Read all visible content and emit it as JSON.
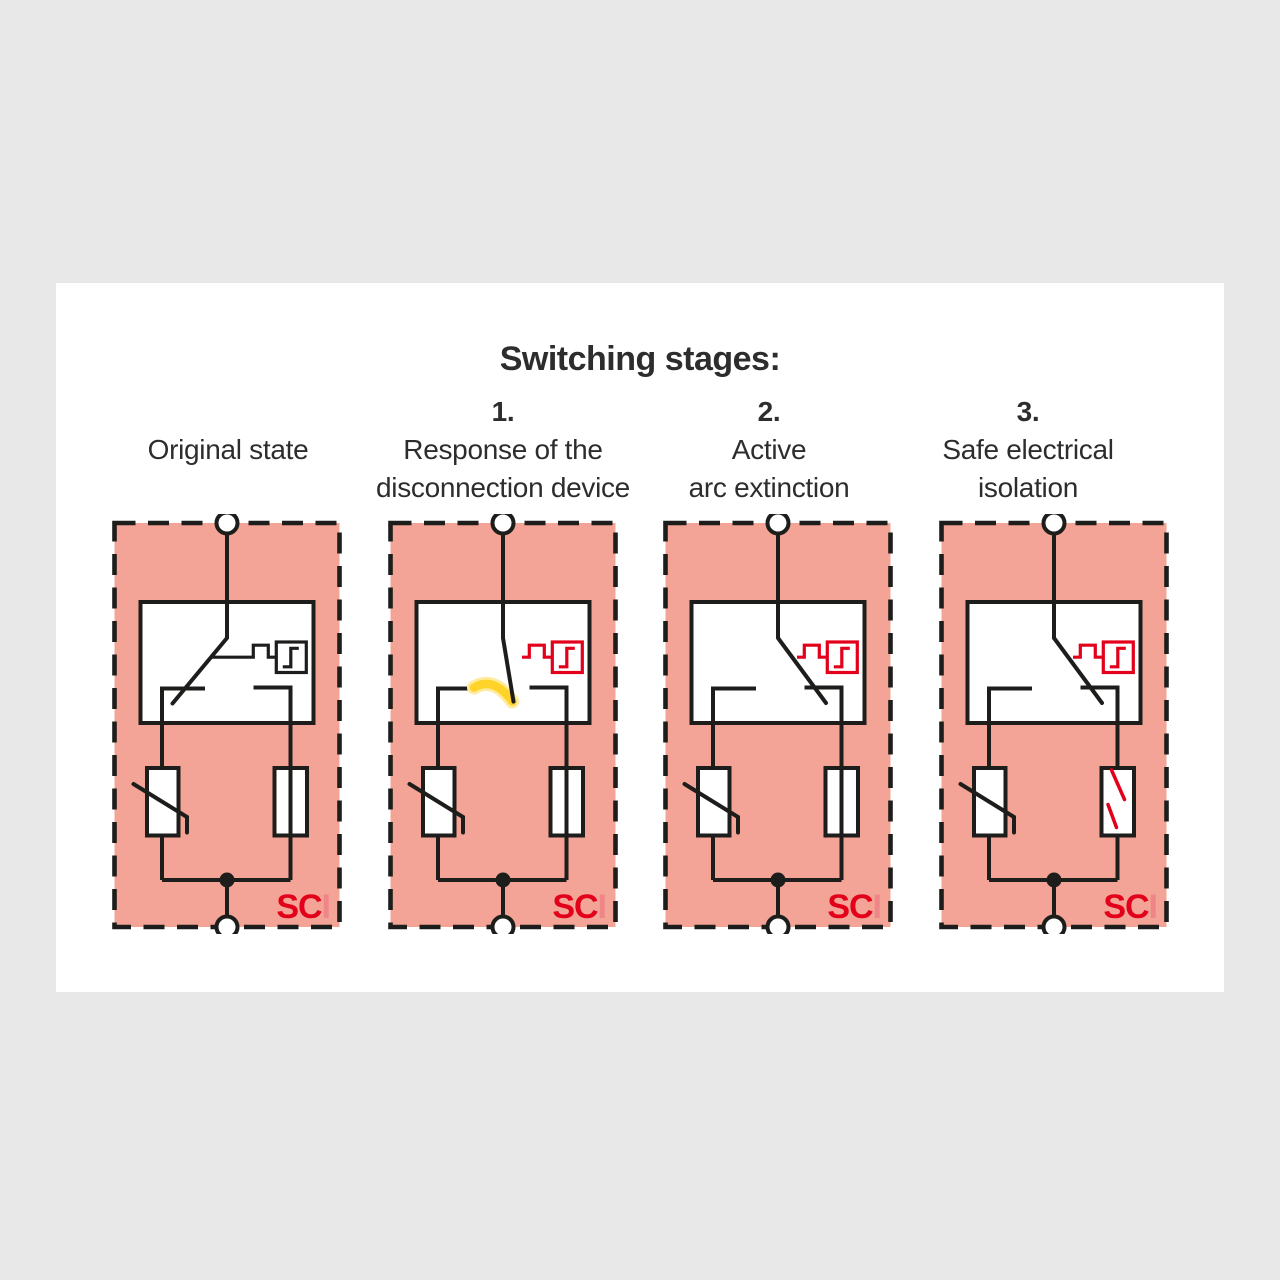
{
  "title": "Switching stages:",
  "logo": {
    "part1": "SC",
    "part2": "I"
  },
  "stages": [
    {
      "number": "",
      "label_lines": [
        "Original state"
      ],
      "switch": "closed",
      "arc": false,
      "backup_fuse": "intact"
    },
    {
      "number": "1.",
      "label_lines": [
        "Response of the",
        "disconnection device"
      ],
      "switch": "opening",
      "arc": true,
      "backup_fuse": "intact"
    },
    {
      "number": "2.",
      "label_lines": [
        "Active",
        "arc extinction"
      ],
      "switch": "open",
      "arc": false,
      "backup_fuse": "intact"
    },
    {
      "number": "3.",
      "label_lines": [
        "Safe electrical",
        "isolation"
      ],
      "switch": "open",
      "arc": false,
      "backup_fuse": "tripped"
    }
  ],
  "colors": {
    "background": "#e8e8e8",
    "card": "#ffffff",
    "panel_fill": "#f3a496",
    "line": "#1d1d1b",
    "accent_red": "#e2001a",
    "logo_i_red": "#ee8688",
    "arc_yellow": "#ffd327",
    "arc_glow": "#ffeb9e",
    "text": "#2d2d2d"
  }
}
